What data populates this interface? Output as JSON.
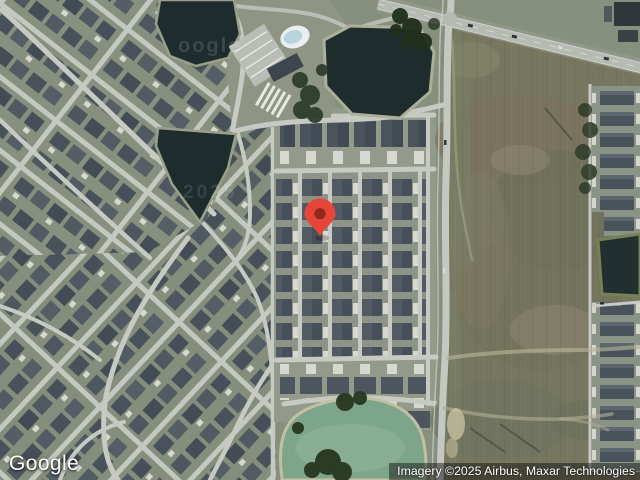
{
  "view": {
    "type": "satellite"
  },
  "branding": {
    "logo_text": "Google"
  },
  "attribution": {
    "text": "Imagery ©2025 Airbus, Maxar Technologies"
  },
  "watermarks": {
    "pond_top": "oogle",
    "pond_mid": "2025"
  },
  "marker": {
    "transform": "translate(320,237)",
    "color": "#E8453A",
    "dot_color": "#8E2A1E"
  },
  "palette": {
    "ground": "#87907e",
    "field": "#77765f",
    "water_dark": "#1e2c2e",
    "water_green": "#7da58a",
    "road": "#c4c8c1",
    "roof": "#4d565f"
  }
}
